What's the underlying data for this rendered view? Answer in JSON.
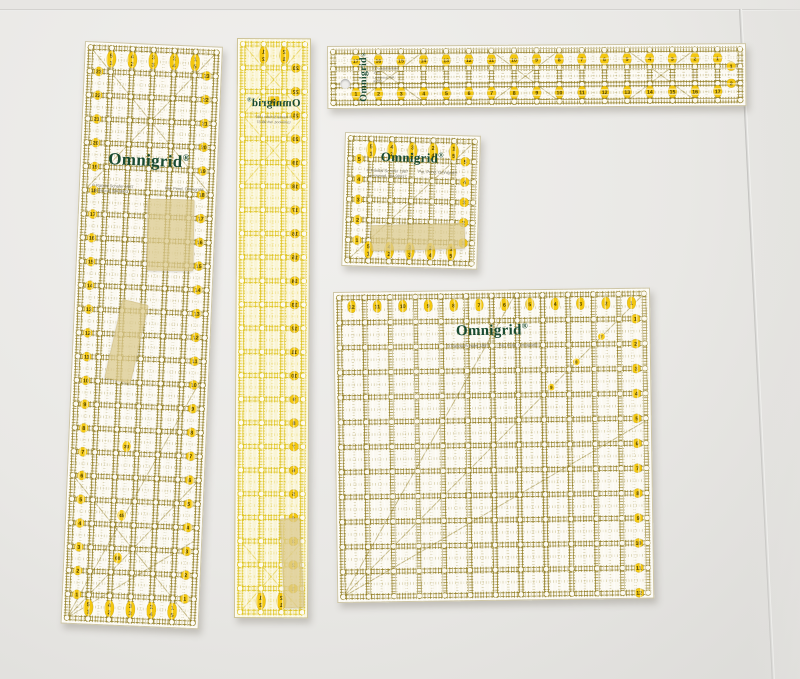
{
  "brand": {
    "name": "Omnigrid",
    "reg": "®",
    "logo_color": "#184a31"
  },
  "palette": {
    "olive": "#8f7a1e",
    "bright": "#ddc013",
    "badge": "#f3c70f",
    "badge_text": "#4a3c00",
    "body": "#fcfaf1",
    "tape": "#dbc98e",
    "board": "#e9e8e5"
  },
  "fine_print": {
    "copyright": "© Randal Schafer 1987",
    "address": "Lynnwood, WA 98037",
    "patent": "Pat. Pend. Omnigrid®"
  },
  "rulers": [
    {
      "id": "ruler-left",
      "inches_w": 6,
      "inches_h": 24,
      "variant": "olive",
      "top_pairs": [
        [
          "5",
          "1"
        ],
        [
          "4",
          "2"
        ],
        [
          "3",
          "3"
        ],
        [
          "2",
          "4"
        ],
        [
          "1",
          "5"
        ]
      ],
      "bottom_pairs": [
        [
          "5",
          "1"
        ],
        [
          "4",
          "2"
        ],
        [
          "3",
          "3"
        ],
        [
          "2",
          "4"
        ],
        [
          "1",
          "5"
        ]
      ],
      "left_numbers": [
        "23",
        "22",
        "21",
        "20",
        "19",
        "18",
        "17",
        "16",
        "15",
        "14",
        "13",
        "12",
        "11",
        "10",
        "9",
        "8",
        "7",
        "6",
        "5",
        "4",
        "3",
        "2",
        "1"
      ],
      "right_numbers": [
        "23",
        "22",
        "21",
        "20",
        "19",
        "18",
        "17",
        "16",
        "15",
        "14",
        "13",
        "12",
        "11",
        "10",
        "9",
        "8",
        "7",
        "6",
        "5",
        "4",
        "3",
        "2",
        "1"
      ],
      "angle_labels": [
        [
          "30",
          2.5,
          16.7
        ],
        [
          "45",
          2.4,
          19.6
        ],
        [
          "60",
          2.3,
          21.4
        ]
      ],
      "diag": [
        [
          0,
          0,
          6,
          6
        ],
        [
          6,
          0,
          0,
          6
        ],
        [
          0,
          24,
          6,
          18
        ],
        [
          0,
          18,
          6,
          24
        ],
        [
          0,
          24,
          6,
          13.6
        ],
        [
          0,
          24,
          6,
          20.5
        ]
      ]
    },
    {
      "id": "ruler-mid",
      "inches_w": 3,
      "inches_h": 24,
      "variant": "bright",
      "mirrored": true,
      "top_pairs": [
        [
          "2",
          "1"
        ],
        [
          "1",
          "2"
        ]
      ],
      "bottom_pairs": [
        [
          "2",
          "1"
        ],
        [
          "1",
          "2"
        ]
      ],
      "left_numbers": [
        "23",
        "22",
        "21",
        "20",
        "19",
        "18",
        "17",
        "16",
        "15",
        "14",
        "13",
        "12",
        "11",
        "10",
        "9",
        "8",
        "7",
        "6",
        "5",
        "4",
        "3",
        "2",
        "1"
      ],
      "center_badge": {
        "label": "18",
        "x": 1.5,
        "y": 2.4
      },
      "diag": [
        [
          0,
          0,
          3,
          3
        ],
        [
          3,
          0,
          0,
          3
        ],
        [
          0,
          3,
          3,
          6
        ],
        [
          3,
          3,
          0,
          6
        ],
        [
          0,
          21,
          3,
          24
        ],
        [
          3,
          21,
          0,
          24
        ]
      ]
    },
    {
      "id": "ruler-h",
      "inches_w": 18,
      "inches_h": 3,
      "variant": "olive",
      "top_numbers": [
        "17",
        "16",
        "15",
        "14",
        "13",
        "12",
        "11",
        "10",
        "9",
        "8",
        "7",
        "6",
        "5",
        "4",
        "3",
        "2",
        "1"
      ],
      "bottom_numbers": [
        "1",
        "2",
        "3",
        "4",
        "5",
        "6",
        "7",
        "8",
        "9",
        "10",
        "11",
        "12",
        "13",
        "14",
        "15",
        "16",
        "17"
      ],
      "right_numbers": [
        "1",
        "2"
      ],
      "diag": [
        [
          1,
          0,
          4,
          3
        ],
        [
          4,
          0,
          1,
          3
        ],
        [
          7,
          0,
          10,
          3
        ],
        [
          10,
          0,
          7,
          3
        ],
        [
          13,
          0,
          16,
          3
        ],
        [
          16,
          0,
          13,
          3
        ]
      ]
    },
    {
      "id": "ruler-small",
      "inches_w": 6,
      "inches_h": 6,
      "variant": "olive",
      "top_pairs": [
        [
          "5",
          "1"
        ],
        [
          "4",
          "2"
        ],
        [
          "3",
          "3"
        ],
        [
          "2",
          "4"
        ],
        [
          "1",
          "5"
        ]
      ],
      "bottom_pairs": [
        [
          "5",
          "1"
        ],
        [
          "4",
          "2"
        ],
        [
          "3",
          "3"
        ],
        [
          "2",
          "4"
        ],
        [
          "1",
          "5"
        ]
      ],
      "left_numbers": [
        "5",
        "4",
        "3",
        "2",
        "1"
      ],
      "right_numbers": [
        "5",
        "4",
        "3",
        "2",
        "1"
      ],
      "diag": [
        [
          0,
          6,
          6,
          0
        ]
      ]
    },
    {
      "id": "ruler-big",
      "inches_w": 12,
      "inches_h": 12,
      "variant": "olive",
      "top_half": true,
      "top_numbers": [
        "12",
        "11",
        "10",
        "9",
        "8",
        "7",
        "6",
        "5",
        "4",
        "3",
        "2",
        "1"
      ],
      "right_numbers": [
        "1",
        "2",
        "3",
        "4",
        "5",
        "6",
        "7",
        "8",
        "9",
        "10",
        "11",
        "12"
      ],
      "diag_numbers": [
        [
          "9",
          8.3
        ],
        [
          "8",
          9.3
        ],
        [
          "7",
          10.3
        ]
      ],
      "diag": [
        [
          0,
          12,
          12,
          0
        ],
        [
          0,
          12,
          6.9,
          0
        ],
        [
          0,
          12,
          12,
          5.1
        ]
      ]
    }
  ]
}
